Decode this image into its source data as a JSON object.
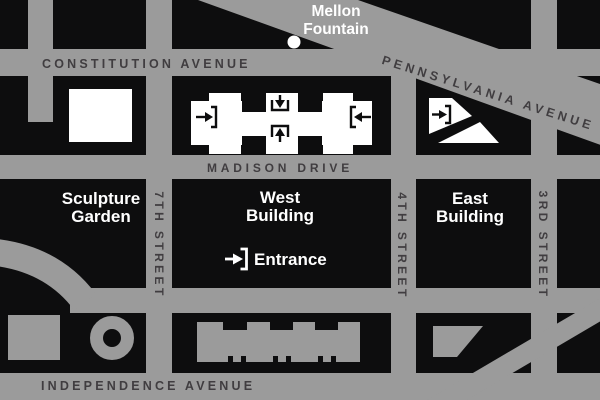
{
  "colors": {
    "bg": "#0d0d0e",
    "street": "#9b9b9b",
    "street_label": "#403d40",
    "building": "#ffffff"
  },
  "streets": {
    "constitution": {
      "label": "CONSTITUTION AVENUE"
    },
    "pennsylvania": {
      "label": "PENNSYLVANIA AVENUE"
    },
    "madison": {
      "label": "MADISON DRIVE"
    },
    "independence": {
      "label": "INDEPENDENCE AVENUE"
    },
    "seventh": {
      "label": "7TH STREET"
    },
    "fourth": {
      "label": "4TH STREET"
    },
    "third": {
      "label": "3RD STREET"
    }
  },
  "places": {
    "mellon_fountain": {
      "line1": "Mellon",
      "line2": "Fountain"
    },
    "sculpture_garden": {
      "line1": "Sculpture",
      "line2": "Garden"
    },
    "west_building": {
      "line1": "West",
      "line2": "Building"
    },
    "east_building": {
      "line1": "East",
      "line2": "Building"
    },
    "entrance": {
      "label": "Entrance"
    }
  }
}
